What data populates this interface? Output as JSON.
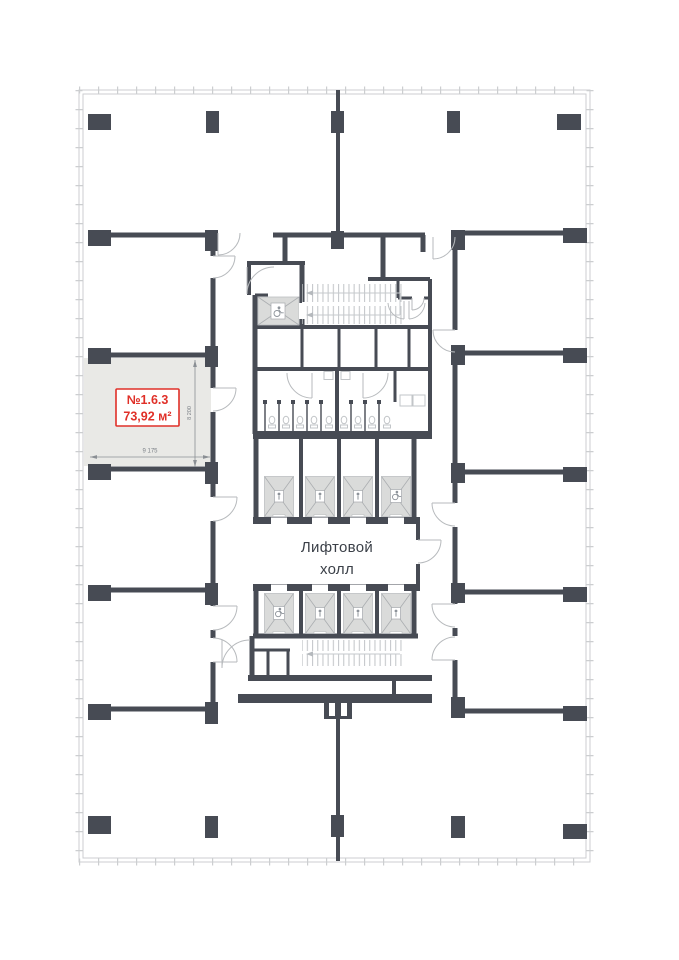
{
  "unit": {
    "number": "№1.6.3",
    "area": "73,92 м²",
    "dim_width": "9 175",
    "dim_height": "8 200"
  },
  "elevator_hall": {
    "line1": "Лифтовой",
    "line2": "холл"
  },
  "colors": {
    "wall": "#474b54",
    "facade": "#ccced0",
    "highlight_fill": "#e9e9e6",
    "unit_accent": "#e03028",
    "elevator_car_fill": "#dadbda",
    "text_dark": "#3b4048",
    "dim_text": "#7c8187",
    "door_arc": "#b7babd",
    "line_light": "#c6c9cc"
  },
  "icons": {
    "wheelchair": "wheelchair-icon",
    "stair_arrow": "stair-direction-arrow"
  }
}
